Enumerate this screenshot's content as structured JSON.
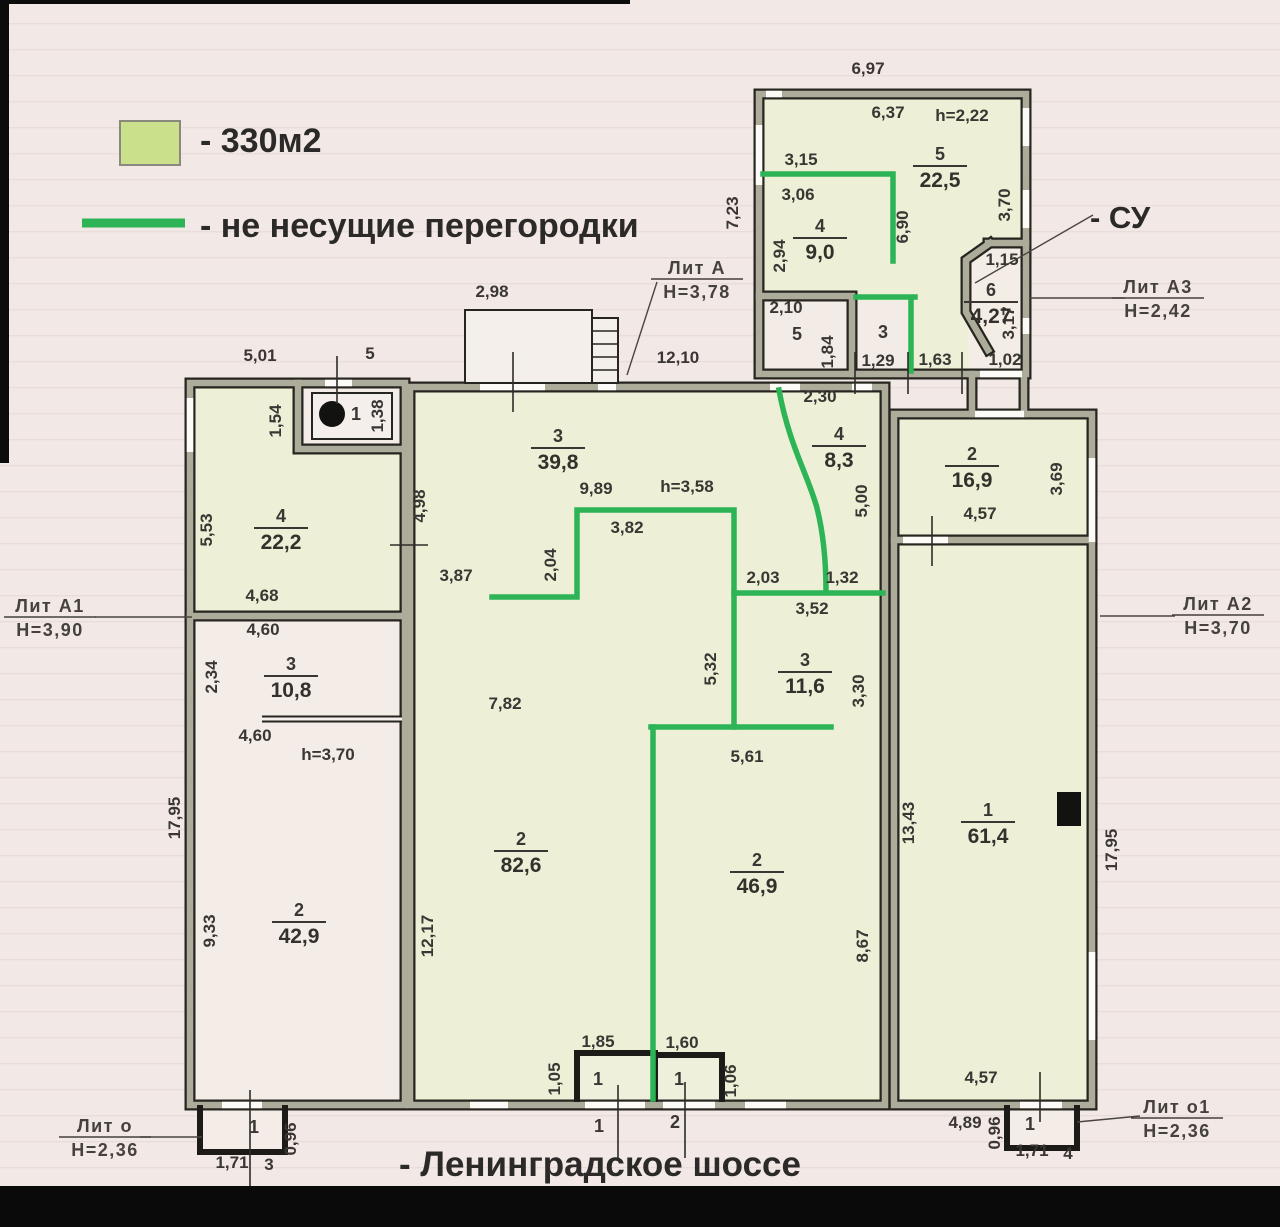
{
  "legend": {
    "area_label": "- 330м2",
    "partition_label": "- не несущие перегородки",
    "area_color": "#cbe08b",
    "partition_color": "#2db457"
  },
  "labels": {
    "street": "- Ленинградское шоссе",
    "bathroom": "- СУ",
    "watermark": "Avito"
  },
  "plan": {
    "lit_labels": [
      {
        "name": "Лит  А",
        "height": "Н=3,78",
        "x": 697,
        "y": 274
      },
      {
        "name": "Лит  А1",
        "height": "Н=3,90",
        "x": 50,
        "y": 612
      },
      {
        "name": "Лит  А2",
        "height": "Н=3,70",
        "x": 1218,
        "y": 610
      },
      {
        "name": "Лит  А3",
        "height": "Н=2,42",
        "x": 1158,
        "y": 293
      },
      {
        "name": "Лит  о",
        "height": "Н=2,36",
        "x": 105,
        "y": 1132
      },
      {
        "name": "Лит  о1",
        "height": "Н=2,36",
        "x": 1177,
        "y": 1113
      }
    ],
    "rooms": [
      {
        "num": "5",
        "area": "22,5",
        "x": 940,
        "y": 160
      },
      {
        "num": "4",
        "area": "9,0",
        "x": 820,
        "y": 232
      },
      {
        "num": "6",
        "area": "4,27",
        "x": 991,
        "y": 296
      },
      {
        "num": "3",
        "area": "39,8",
        "x": 558,
        "y": 442
      },
      {
        "num": "4",
        "area": "8,3",
        "x": 839,
        "y": 440
      },
      {
        "num": "2",
        "area": "16,9",
        "x": 972,
        "y": 460
      },
      {
        "num": "4",
        "area": "22,2",
        "x": 281,
        "y": 522
      },
      {
        "num": "3",
        "area": "10,8",
        "x": 291,
        "y": 670
      },
      {
        "num": "3",
        "area": "11,6",
        "x": 805,
        "y": 666
      },
      {
        "num": "2",
        "area": "82,6",
        "x": 521,
        "y": 845
      },
      {
        "num": "2",
        "area": "46,9",
        "x": 757,
        "y": 866
      },
      {
        "num": "2",
        "area": "42,9",
        "x": 299,
        "y": 916
      },
      {
        "num": "1",
        "area": "61,4",
        "x": 988,
        "y": 816
      }
    ],
    "room_numbers": [
      {
        "num": "1",
        "x": 356,
        "y": 420
      },
      {
        "num": "5",
        "x": 797,
        "y": 340
      },
      {
        "num": "3",
        "x": 883,
        "y": 338
      },
      {
        "num": "1",
        "x": 598,
        "y": 1085
      },
      {
        "num": "1",
        "x": 679,
        "y": 1085
      },
      {
        "num": "1",
        "x": 599,
        "y": 1132
      },
      {
        "num": "2",
        "x": 675,
        "y": 1128
      },
      {
        "num": "1",
        "x": 254,
        "y": 1133
      },
      {
        "num": "1",
        "x": 1030,
        "y": 1130
      }
    ],
    "dims": [
      {
        "t": "6,97",
        "x": 868,
        "y": 74
      },
      {
        "t": "6,37",
        "x": 888,
        "y": 118
      },
      {
        "t": "h=2,22",
        "x": 962,
        "y": 121
      },
      {
        "t": "3,15",
        "x": 801,
        "y": 165
      },
      {
        "t": "3,06",
        "x": 798,
        "y": 200
      },
      {
        "t": "2,94",
        "x": 785,
        "y": 256,
        "r": 1
      },
      {
        "t": "6,90",
        "x": 908,
        "y": 227,
        "r": 1
      },
      {
        "t": "3,70",
        "x": 1010,
        "y": 205,
        "r": 1
      },
      {
        "t": "7,23",
        "x": 738,
        "y": 213,
        "r": 1
      },
      {
        "t": "2,10",
        "x": 786,
        "y": 313
      },
      {
        "t": "1,84",
        "x": 833,
        "y": 352,
        "r": 1
      },
      {
        "t": "1,29",
        "x": 878,
        "y": 366
      },
      {
        "t": "1,63",
        "x": 935,
        "y": 365
      },
      {
        "t": "1,15",
        "x": 1002,
        "y": 265
      },
      {
        "t": "3,17",
        "x": 1014,
        "y": 323,
        "r": 1
      },
      {
        "t": "1,02",
        "x": 1005,
        "y": 365
      },
      {
        "t": "2,98",
        "x": 492,
        "y": 297
      },
      {
        "t": "5,01",
        "x": 260,
        "y": 361
      },
      {
        "t": "5",
        "x": 370,
        "y": 359
      },
      {
        "t": "12,10",
        "x": 678,
        "y": 363
      },
      {
        "t": "2,30",
        "x": 820,
        "y": 402
      },
      {
        "t": "1,54",
        "x": 281,
        "y": 421,
        "r": 1
      },
      {
        "t": "1,38",
        "x": 383,
        "y": 416,
        "r": 1
      },
      {
        "t": "4,98",
        "x": 425,
        "y": 506,
        "r": 1
      },
      {
        "t": "3,87",
        "x": 456,
        "y": 581
      },
      {
        "t": "2,04",
        "x": 556,
        "y": 565,
        "r": 1
      },
      {
        "t": "9,89",
        "x": 596,
        "y": 494
      },
      {
        "t": "h=3,58",
        "x": 687,
        "y": 492
      },
      {
        "t": "3,82",
        "x": 627,
        "y": 533
      },
      {
        "t": "2,03",
        "x": 763,
        "y": 583
      },
      {
        "t": "1,32",
        "x": 842,
        "y": 583
      },
      {
        "t": "3,52",
        "x": 812,
        "y": 614
      },
      {
        "t": "5,00",
        "x": 867,
        "y": 501,
        "r": 1
      },
      {
        "t": "5,32",
        "x": 716,
        "y": 669,
        "r": 1
      },
      {
        "t": "5,61",
        "x": 747,
        "y": 762
      },
      {
        "t": "7,82",
        "x": 505,
        "y": 709
      },
      {
        "t": "3,30",
        "x": 864,
        "y": 691,
        "r": 1
      },
      {
        "t": "12,17",
        "x": 433,
        "y": 936,
        "r": 1
      },
      {
        "t": "8,67",
        "x": 868,
        "y": 946,
        "r": 1
      },
      {
        "t": "1,85",
        "x": 598,
        "y": 1047
      },
      {
        "t": "1,60",
        "x": 682,
        "y": 1048
      },
      {
        "t": "1,05",
        "x": 560,
        "y": 1079,
        "r": 1
      },
      {
        "t": "1,06",
        "x": 736,
        "y": 1081,
        "r": 1
      },
      {
        "t": "5,53",
        "x": 212,
        "y": 530,
        "r": 1
      },
      {
        "t": "4,68",
        "x": 262,
        "y": 601
      },
      {
        "t": "4,60",
        "x": 263,
        "y": 635
      },
      {
        "t": "2,34",
        "x": 217,
        "y": 677,
        "r": 1
      },
      {
        "t": "4,60",
        "x": 255,
        "y": 741
      },
      {
        "t": "h=3,70",
        "x": 328,
        "y": 760
      },
      {
        "t": "9,33",
        "x": 215,
        "y": 931,
        "r": 1
      },
      {
        "t": "17,95",
        "x": 180,
        "y": 818,
        "r": 1
      },
      {
        "t": "4,57",
        "x": 980,
        "y": 519
      },
      {
        "t": "3,69",
        "x": 1062,
        "y": 479,
        "r": 1
      },
      {
        "t": "13,43",
        "x": 914,
        "y": 823,
        "r": 1
      },
      {
        "t": "17,95",
        "x": 1117,
        "y": 850,
        "r": 1
      },
      {
        "t": "4,57",
        "x": 981,
        "y": 1083
      },
      {
        "t": "4,89",
        "x": 965,
        "y": 1128
      },
      {
        "t": "0,96",
        "x": 1000,
        "y": 1133,
        "r": 1
      },
      {
        "t": "1,71",
        "x": 1032,
        "y": 1156
      },
      {
        "t": "4",
        "x": 1068,
        "y": 1159
      },
      {
        "t": "0,96",
        "x": 296,
        "y": 1139,
        "r": 1
      },
      {
        "t": "1,71",
        "x": 232,
        "y": 1168
      },
      {
        "t": "3",
        "x": 269,
        "y": 1170
      }
    ]
  }
}
